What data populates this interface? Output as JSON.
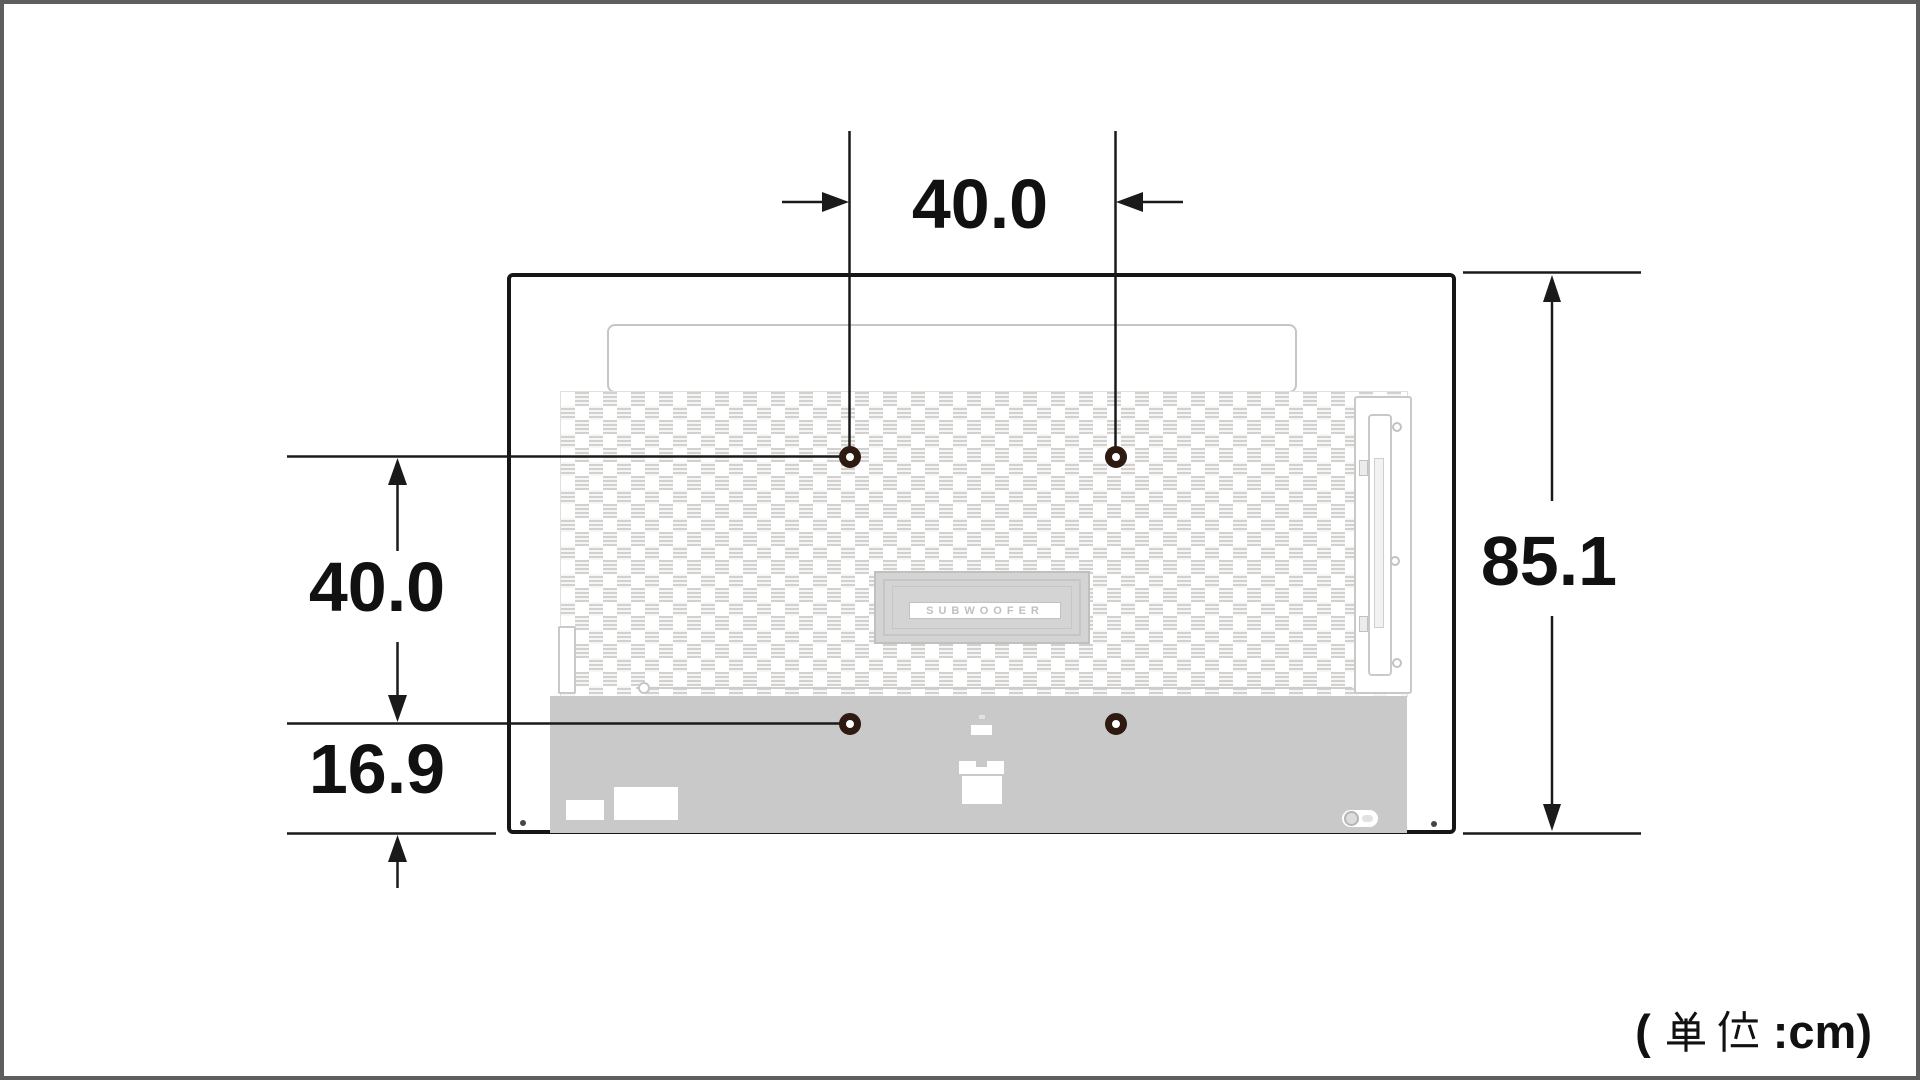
{
  "diagram": {
    "type": "tv-rear-mounting-dimensions",
    "unit_note": {
      "full": "( 単位 :cm)",
      "prefix": "(",
      "kanji": "単位",
      "suffix": ":cm)"
    },
    "dimensions": {
      "mount_hole_width": "40.0",
      "mount_hole_height": "40.0",
      "bottom_offset": "16.9",
      "panel_height": "85.1"
    },
    "tv": {
      "subwoofer_label": "SUBWOOFER"
    },
    "colors": {
      "frame_border": "#5e5e5e",
      "tv_outline": "#161616",
      "dimension_line": "#1a1a1a",
      "screw_ring": "#2e1a10",
      "bottom_panel_gray": "#c9c9c9",
      "grille_gray": "#d3d1cf"
    }
  }
}
